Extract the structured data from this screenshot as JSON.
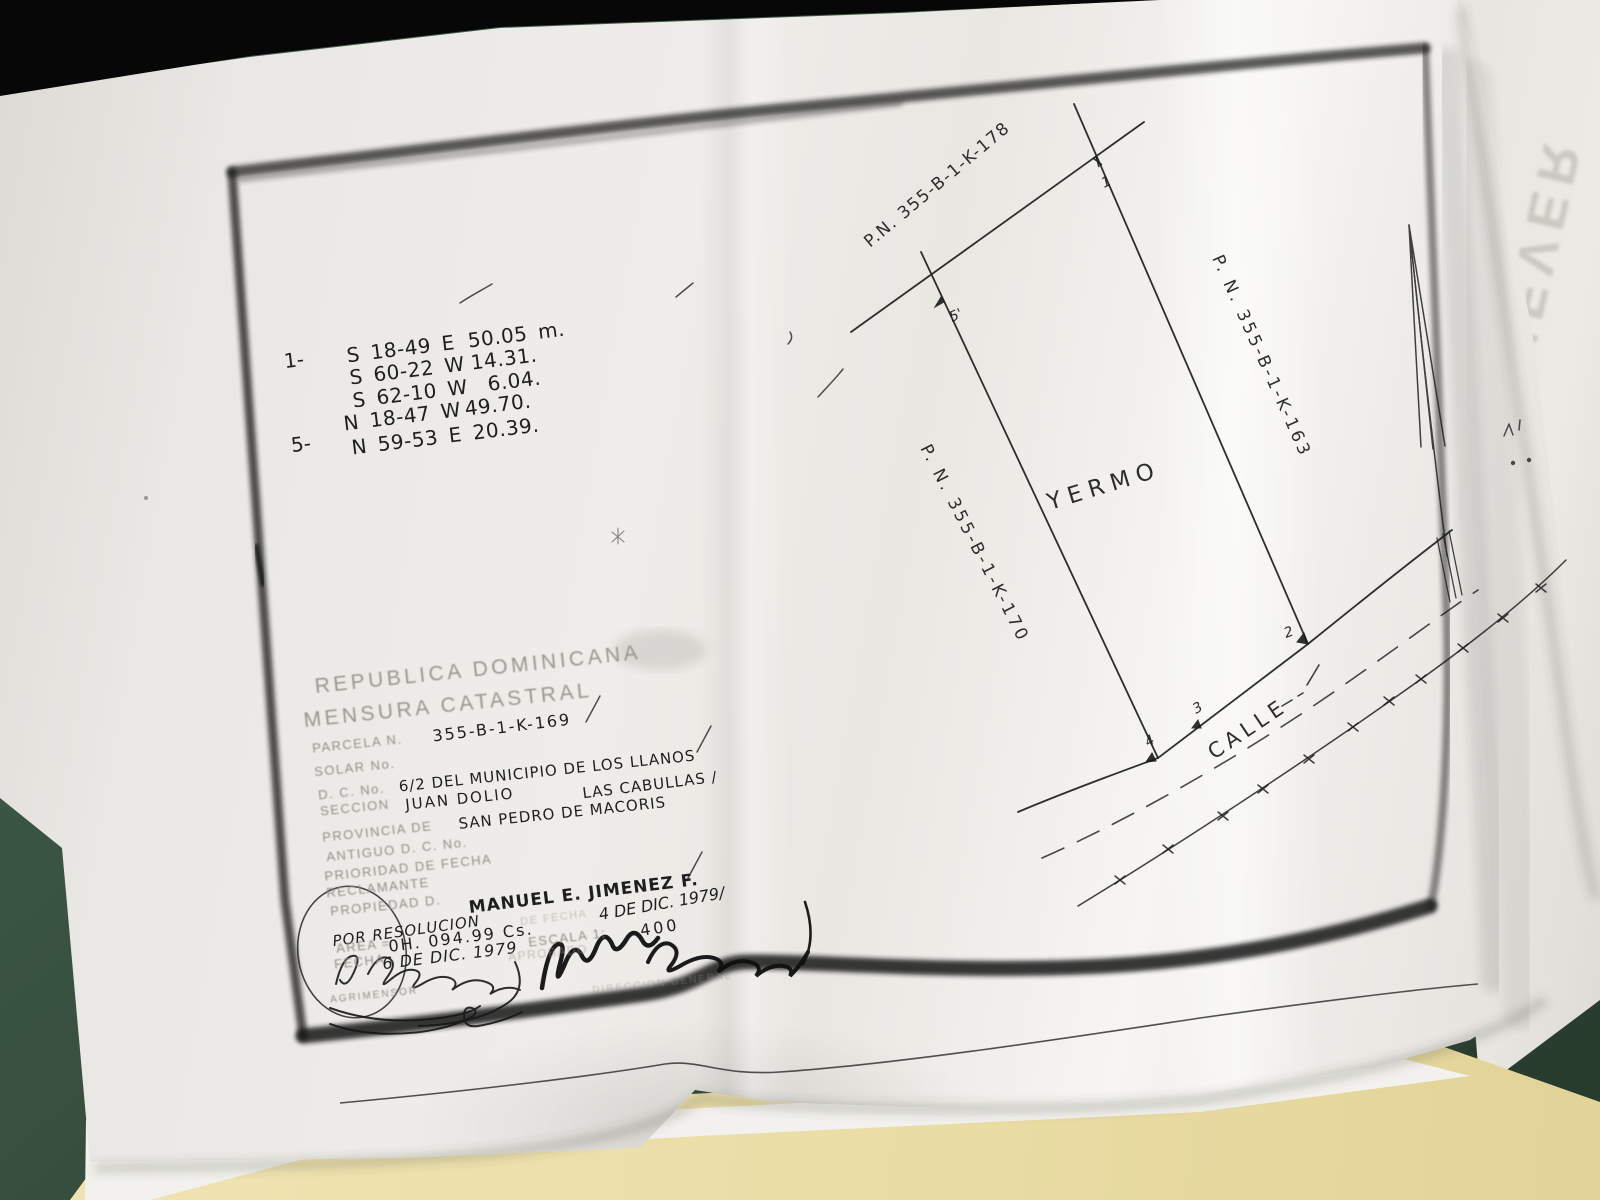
{
  "scene": {
    "desk_color": "#35523f",
    "folder_color": "#eee2ad",
    "under_sheet_watermark": "NEVER"
  },
  "plan": {
    "bearings_list": {
      "start_index_label": "1-",
      "end_index_label": "5-",
      "rows": [
        {
          "bearing": "S 18-49 E",
          "distance": "50.05 m."
        },
        {
          "bearing": "S 60-22 W",
          "distance": "14.31."
        },
        {
          "bearing": "S 62-10 W",
          "distance": "6.04."
        },
        {
          "bearing": "N 18-47 W",
          "distance": "49.70."
        },
        {
          "bearing": "N 59-53 E",
          "distance": "20.39."
        }
      ]
    },
    "neighbor_parcels": {
      "north": "P.N. 355-B-1-K-178",
      "east": "P. N. 355-B-1-K-163",
      "west": "P. N. 355-B-1-K-170"
    },
    "land_use_label": "YERMO",
    "street_label": "CALLE",
    "vertices": {
      "top_right": "1",
      "road_right": "2",
      "road_mid": "3",
      "road_left": "4",
      "top_left": "5'"
    }
  },
  "title_block": {
    "country": "REPUBLICA DOMINICANA",
    "document_type": "MENSURA CATASTRAL",
    "parcela_label": "PARCELA N.",
    "parcela_value": "355-B-1-K-169",
    "solar_label": "SOLAR No.",
    "dc_label": "D. C. No.",
    "dc_value": "6/2 DEL MUNICIPIO DE LOS LLANOS",
    "seccion_label": "SECCION",
    "seccion_value": "JUAN DOLIO",
    "lugar_value": "LAS CABULLAS /",
    "provincia_label": "PROVINCIA DE",
    "provincia_value": "SAN PEDRO DE MACORIS",
    "antiguo_label": "ANTIGUO D. C. No.",
    "prioridad_label": "PRIORIDAD DE FECHA",
    "reclamante_label": "RECLAMANTE",
    "propiedad_label": "PROPIEDAD D.",
    "propiedad_value": "MANUEL E. JIMENEZ F.",
    "resolucion_note": "POR RESOLUCION",
    "resolucion_fecha_label": "DE FECHA",
    "resolucion_fecha_value": "4 DE DIC. 1979/",
    "area_label": "AREA =",
    "area_value": "0H. 094.99 Cs.",
    "escala_label": "ESCALA 1:",
    "escala_value": "400",
    "fecha_label": "FECHA",
    "fecha_value": "6 DE DIC. 1979",
    "aprobado_label": "APROBADO",
    "agrimensor_label": "AGRIMENSOR",
    "direccion_label": "DIRECCION GENERAL"
  }
}
